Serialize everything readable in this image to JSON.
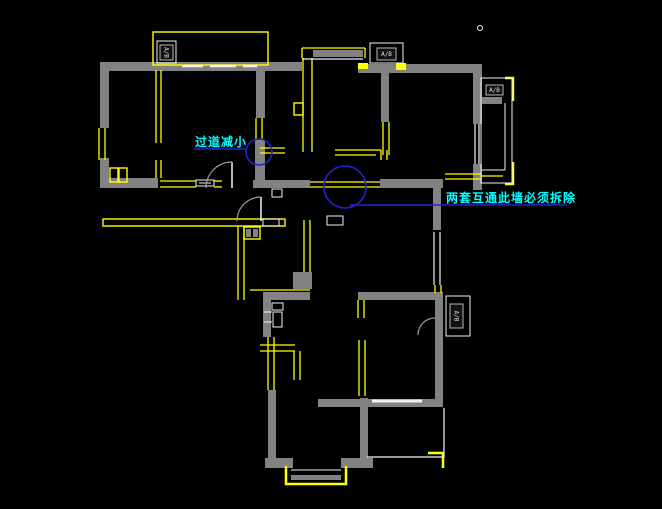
{
  "canvas": {
    "width": 662,
    "height": 509,
    "background": "#000000"
  },
  "colors": {
    "wall": "#828282",
    "wall_dark": "#6e6e6e",
    "yellow": "#ffff00",
    "white": "#f2f2f2",
    "blue": "#2222d0",
    "cyan": "#00ffff",
    "arc": "#9c9c9c",
    "label_stroke": "#b8b8b8",
    "label_text": "#e0e0e0"
  },
  "annotations": {
    "note1": {
      "text": "过道减小",
      "x": 195,
      "y": 136
    },
    "note2": {
      "text": "两套互通此墙必须拆除",
      "x": 446,
      "y": 192
    }
  },
  "floorplan": {
    "gray_rects": [
      [
        100,
        62,
        202,
        9
      ],
      [
        100,
        62,
        9,
        66
      ],
      [
        100,
        158,
        9,
        30
      ],
      [
        100,
        178,
        58,
        10
      ],
      [
        253,
        180,
        57,
        8
      ],
      [
        380,
        179,
        63,
        9
      ],
      [
        358,
        64,
        123,
        9
      ],
      [
        473,
        64,
        9,
        60
      ],
      [
        473,
        164,
        9,
        26
      ],
      [
        381,
        72,
        8,
        50
      ],
      [
        313,
        50,
        50,
        7
      ],
      [
        433,
        188,
        8,
        42
      ],
      [
        256,
        62,
        9,
        56
      ],
      [
        255,
        140,
        10,
        40
      ],
      [
        263,
        292,
        47,
        8
      ],
      [
        358,
        292,
        85,
        8
      ],
      [
        435,
        300,
        8,
        105
      ],
      [
        263,
        295,
        8,
        42
      ],
      [
        268,
        390,
        8,
        76
      ],
      [
        265,
        458,
        28,
        10
      ],
      [
        341,
        458,
        32,
        10
      ],
      [
        360,
        398,
        8,
        68
      ],
      [
        318,
        399,
        125,
        8
      ],
      [
        293,
        272,
        19,
        17
      ],
      [
        291,
        475,
        50,
        5
      ],
      [
        246,
        229,
        5,
        8
      ],
      [
        253,
        229,
        5,
        8
      ],
      [
        482,
        97,
        20,
        7
      ]
    ],
    "yellow_segments": [
      [
        156,
        70,
        156,
        143
      ],
      [
        161,
        70,
        161,
        143
      ],
      [
        156,
        160,
        156,
        178
      ],
      [
        161,
        160,
        161,
        178
      ],
      [
        160,
        181,
        196,
        181
      ],
      [
        160,
        187,
        196,
        187
      ],
      [
        214,
        181,
        222,
        181
      ],
      [
        214,
        187,
        222,
        187
      ],
      [
        310,
        182,
        380,
        182
      ],
      [
        310,
        187,
        380,
        187
      ],
      [
        99,
        128,
        99,
        160
      ],
      [
        105,
        128,
        105,
        160
      ],
      [
        302,
        48,
        365,
        48
      ],
      [
        302,
        48,
        302,
        58
      ],
      [
        365,
        48,
        365,
        58
      ],
      [
        303,
        58,
        303,
        152
      ],
      [
        312,
        58,
        312,
        152
      ],
      [
        335,
        150,
        381,
        150
      ],
      [
        335,
        155,
        376,
        155
      ],
      [
        381,
        150,
        381,
        160
      ],
      [
        387,
        150,
        387,
        160
      ],
      [
        383,
        122,
        383,
        155
      ],
      [
        389,
        122,
        389,
        155
      ],
      [
        445,
        174,
        481,
        174
      ],
      [
        445,
        179,
        481,
        179
      ],
      [
        481,
        176,
        503,
        176
      ],
      [
        238,
        226,
        238,
        300
      ],
      [
        244,
        226,
        244,
        300
      ],
      [
        304,
        220,
        304,
        272
      ],
      [
        310,
        220,
        310,
        272
      ],
      [
        250,
        290,
        310,
        290
      ],
      [
        358,
        300,
        358,
        318
      ],
      [
        364,
        300,
        364,
        318
      ],
      [
        359,
        340,
        359,
        396
      ],
      [
        365,
        340,
        365,
        396
      ],
      [
        268,
        337,
        268,
        390
      ],
      [
        274,
        337,
        274,
        390
      ],
      [
        260,
        345,
        295,
        345
      ],
      [
        260,
        351,
        295,
        351
      ],
      [
        294,
        351,
        294,
        380
      ],
      [
        300,
        351,
        300,
        380
      ],
      [
        435,
        285,
        435,
        293
      ],
      [
        441,
        285,
        441,
        293
      ],
      [
        256,
        118,
        256,
        140
      ],
      [
        262,
        118,
        262,
        140
      ],
      [
        260,
        148,
        285,
        148
      ],
      [
        260,
        153,
        285,
        153
      ]
    ],
    "yellow_outlines": [
      [
        153,
        32,
        115,
        33
      ],
      [
        103,
        219,
        182,
        7
      ],
      [
        110,
        168,
        8,
        14
      ],
      [
        119,
        168,
        8,
        14
      ],
      [
        244,
        227,
        16,
        12
      ],
      [
        294,
        103,
        9,
        12
      ]
    ],
    "yellow_fills": [
      [
        358,
        63,
        10,
        6
      ],
      [
        396,
        63,
        10,
        7
      ]
    ],
    "yellow_polylines": [
      [
        [
          286,
          466
        ],
        [
          286,
          484
        ],
        [
          346,
          484
        ],
        [
          346,
          466
        ]
      ],
      [
        [
          505,
          78
        ],
        [
          513,
          78
        ],
        [
          513,
          101
        ]
      ],
      [
        [
          513,
          162
        ],
        [
          513,
          184
        ],
        [
          505,
          184
        ]
      ],
      [
        [
          428,
          453
        ],
        [
          443,
          453
        ],
        [
          443,
          468
        ]
      ]
    ],
    "white_segments": [
      [
        182,
        66,
        203,
        66,
        2.5
      ],
      [
        210,
        66,
        236,
        66,
        2.5
      ],
      [
        243,
        66,
        257,
        66,
        2.5
      ],
      [
        302,
        59,
        363,
        59,
        1.2
      ],
      [
        475,
        124,
        475,
        164,
        1.2
      ],
      [
        479,
        124,
        479,
        164,
        1.2
      ],
      [
        505,
        103,
        505,
        170,
        1
      ],
      [
        482,
        170,
        505,
        170,
        1
      ],
      [
        434,
        232,
        434,
        285,
        1.2
      ],
      [
        440,
        232,
        440,
        285,
        1.2
      ],
      [
        372,
        401,
        422,
        401,
        3
      ],
      [
        232,
        162,
        232,
        188,
        1.5
      ],
      [
        261,
        197,
        261,
        221,
        1.5
      ],
      [
        291,
        470,
        341,
        470,
        1
      ],
      [
        199,
        183,
        211,
        183,
        1
      ],
      [
        264,
        312,
        272,
        312,
        1
      ],
      [
        264,
        322,
        272,
        322,
        1
      ]
    ],
    "white_outlines": [
      [
        481,
        78,
        31,
        105
      ],
      [
        196,
        180,
        18,
        6
      ],
      [
        272,
        189,
        10,
        8
      ],
      [
        263,
        219,
        16,
        7
      ],
      [
        327,
        216,
        16,
        9
      ],
      [
        272,
        303,
        11,
        7
      ],
      [
        273,
        312,
        9,
        15
      ]
    ],
    "white_polylines": [
      [
        [
          444,
          408
        ],
        [
          444,
          457
        ],
        [
          367,
          457
        ]
      ]
    ],
    "tiny_circles": [
      {
        "cx": 480,
        "cy": 28,
        "r": 2.5
      }
    ],
    "door_arcs": [
      {
        "d": "M232,162 A26,26 0 0 0 206,188"
      },
      {
        "d": "M261,197 A24,24 0 0 0 237,221"
      },
      {
        "d": "M435,318 A17,17 0 0 0 418,335"
      }
    ],
    "blue_circles": [
      {
        "cx": 259,
        "cy": 152,
        "r": 13
      },
      {
        "cx": 345,
        "cy": 187,
        "r": 21
      }
    ],
    "blue_segments": [
      [
        194,
        149,
        247,
        149
      ],
      [
        350,
        205,
        567,
        205
      ]
    ],
    "labels": [
      {
        "outer": [
          157,
          41,
          19,
          22
        ],
        "inner": [
          160,
          45,
          13,
          15
        ],
        "text": "A/B",
        "rot": 90
      },
      {
        "outer": [
          370,
          43,
          33,
          20
        ],
        "inner": [
          377,
          48,
          19,
          12
        ],
        "text": "A/B",
        "rot": 0
      },
      {
        "outer": null,
        "inner": [
          486,
          85,
          17,
          10
        ],
        "text": "A/B",
        "rot": 0
      },
      {
        "outer": [
          446,
          296,
          24,
          40
        ],
        "inner": [
          450,
          304,
          13,
          24
        ],
        "text": "A/B",
        "rot": 90
      }
    ]
  }
}
